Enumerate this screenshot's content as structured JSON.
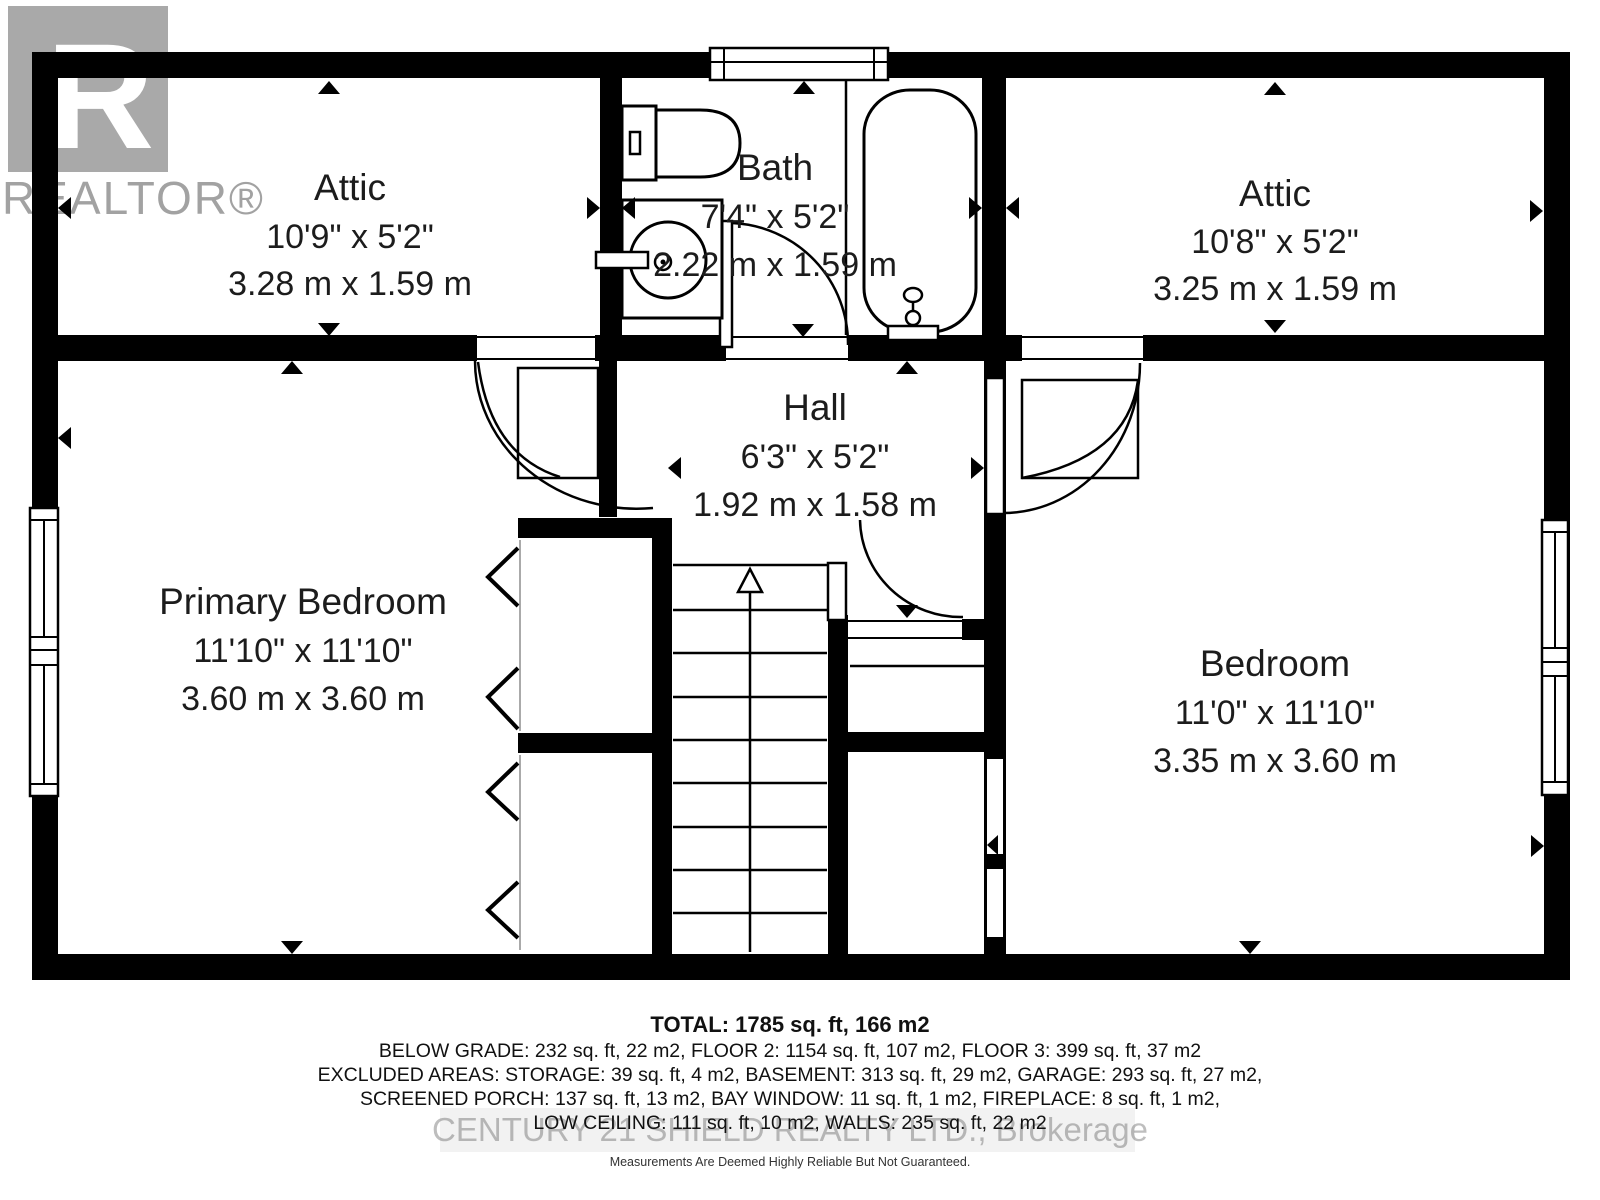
{
  "watermarks": {
    "realtor_logo_letter": "R",
    "realtor_text": "REALTOR®",
    "brokerage_text": "CENTURY 21 SHIELD REALTY LTD., Brokerage"
  },
  "rooms": {
    "attic_left": {
      "name": "Attic",
      "imperial": "10'9\" x 5'2\"",
      "metric": "3.28 m x 1.59 m"
    },
    "bath": {
      "name": "Bath",
      "imperial": "7'4\" x 5'2\"",
      "metric": "2.22 m x 1.59 m"
    },
    "attic_right": {
      "name": "Attic",
      "imperial": "10'8\" x 5'2\"",
      "metric": "3.25 m x 1.59 m"
    },
    "hall": {
      "name": "Hall",
      "imperial": "6'3\" x 5'2\"",
      "metric": "1.92 m x 1.58 m"
    },
    "primary_bedroom": {
      "name": "Primary Bedroom",
      "imperial": "11'10\" x 11'10\"",
      "metric": "3.60 m x 3.60 m"
    },
    "bedroom": {
      "name": "Bedroom",
      "imperial": "11'0\" x 11'10\"",
      "metric": "3.35 m x 3.60 m"
    }
  },
  "summary": {
    "total": "TOTAL: 1785 sq. ft, 166 m2",
    "line1": "BELOW GRADE: 232 sq. ft, 22 m2, FLOOR 2: 1154 sq. ft, 107 m2, FLOOR 3: 399 sq. ft, 37 m2",
    "line2": "EXCLUDED AREAS: STORAGE: 39 sq. ft, 4 m2, BASEMENT: 313 sq. ft, 29 m2, GARAGE: 293 sq. ft, 27 m2,",
    "line3": "SCREENED PORCH: 137 sq. ft, 13 m2, BAY WINDOW: 11 sq. ft, 1 m2, FIREPLACE: 8 sq. ft, 1 m2,",
    "line4": "LOW CEILING: 111 sq. ft, 10 m2, WALLS: 235 sq. ft, 22 m2",
    "disclaimer": "Measurements Are Deemed Highly Reliable But Not Guaranteed."
  }
}
